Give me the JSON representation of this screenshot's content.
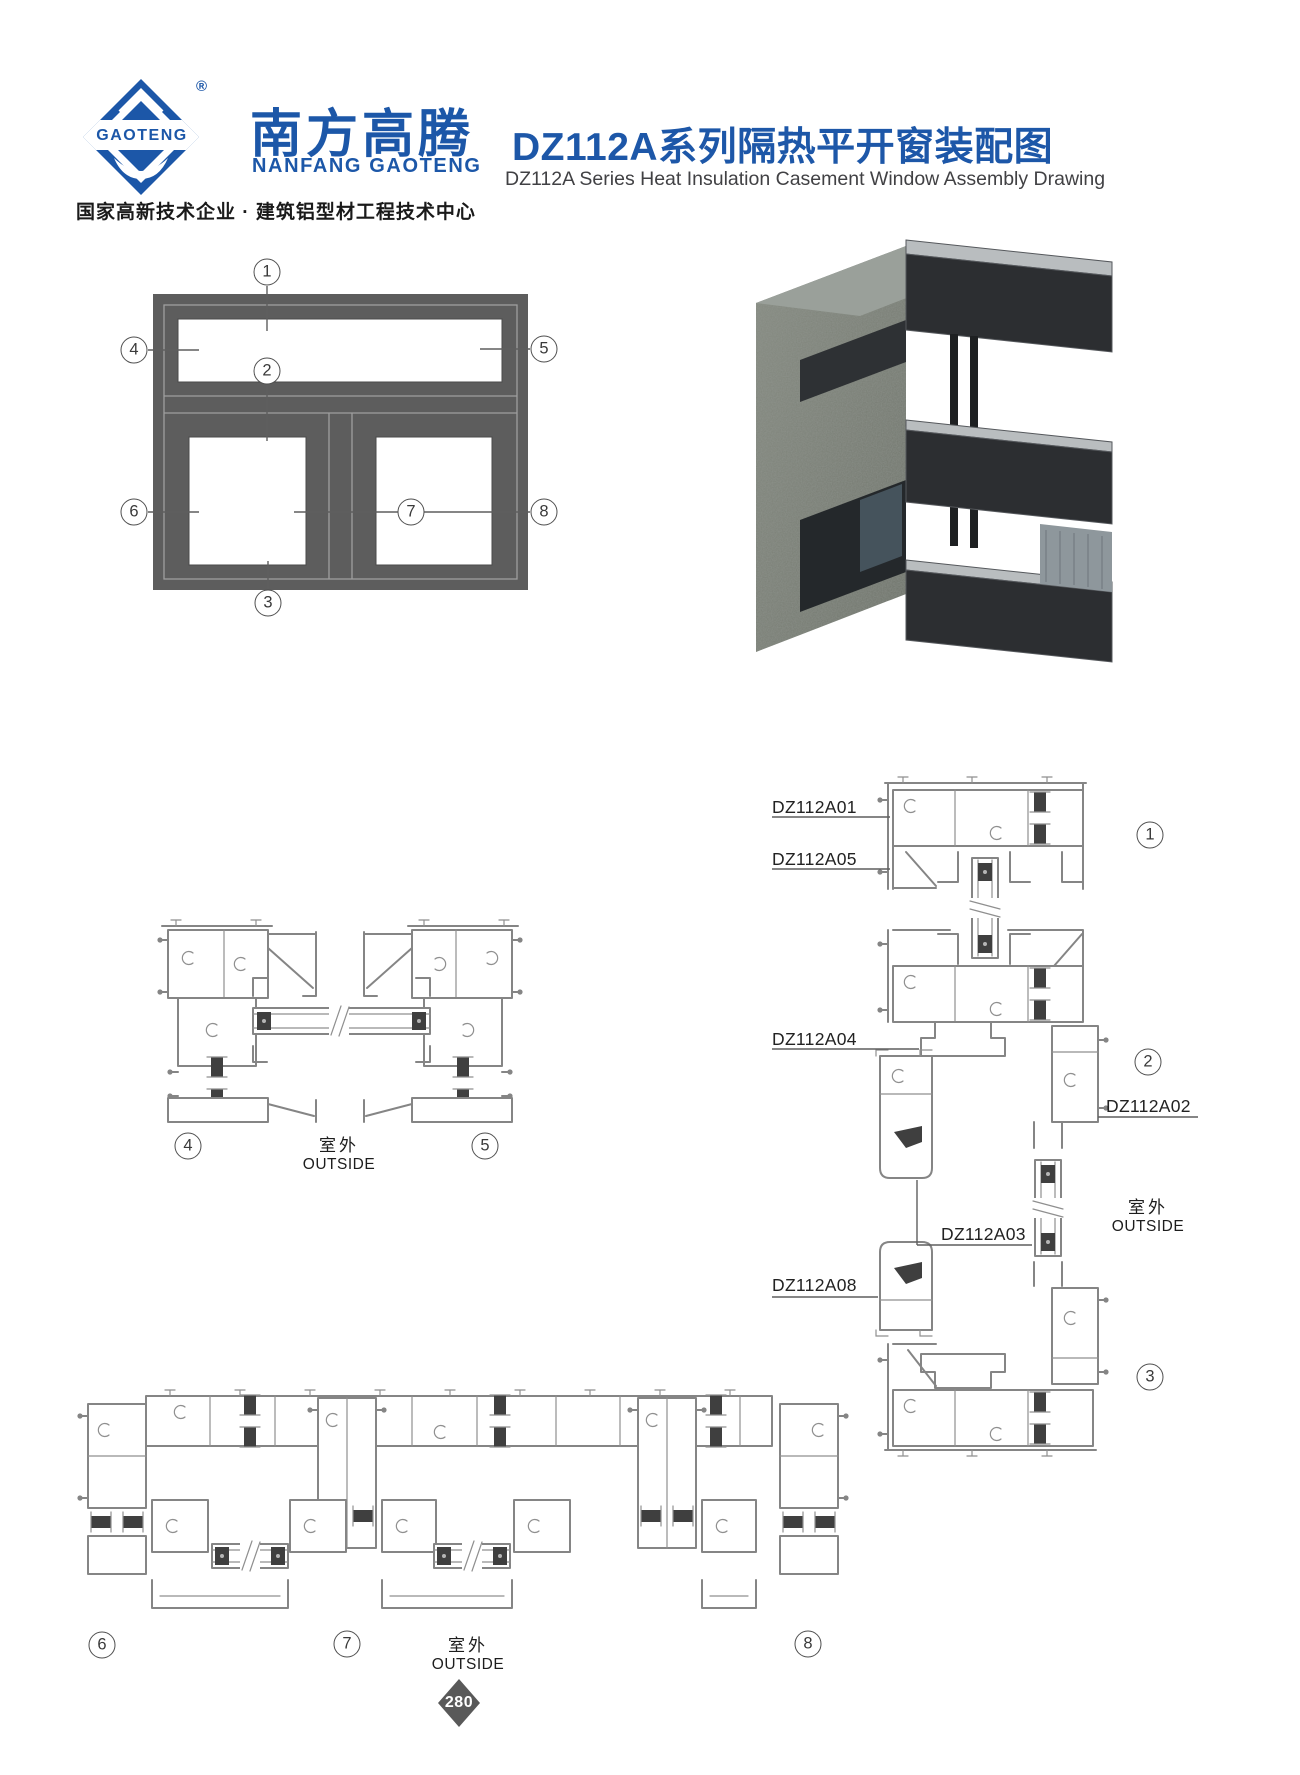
{
  "brand": {
    "logo_text": "GAOTENG",
    "registered_mark": "®",
    "name_cn": "南方高腾",
    "name_en": "NANFANG GAOTENG",
    "tagline": "国家高新技术企业 · 建筑铝型材工程技术中心",
    "blue": "#1c57a8"
  },
  "title": {
    "cn": "DZ112A系列隔热平开窗装配图",
    "en": "DZ112A Series Heat Insulation Casement Window Assembly Drawing"
  },
  "callouts": {
    "c1": "1",
    "c2": "2",
    "c3": "3",
    "c4": "4",
    "c5": "5",
    "c6": "6",
    "c7": "7",
    "c8": "8"
  },
  "profiles": {
    "a01": "DZ112A01",
    "a05": "DZ112A05",
    "a04": "DZ112A04",
    "a02": "DZ112A02",
    "a03": "DZ112A03",
    "a08": "DZ112A08"
  },
  "outside": {
    "cn": "室外",
    "en": "OUTSIDE"
  },
  "footer": {
    "page_number": "280"
  },
  "colors": {
    "line_gray": "#858585",
    "dark_gasket": "#3f3f3f",
    "elevation_frame": "#5d5d5d",
    "render_wall": "#7e837b",
    "render_profile": "#2b2d30",
    "diamond": "#595959"
  }
}
